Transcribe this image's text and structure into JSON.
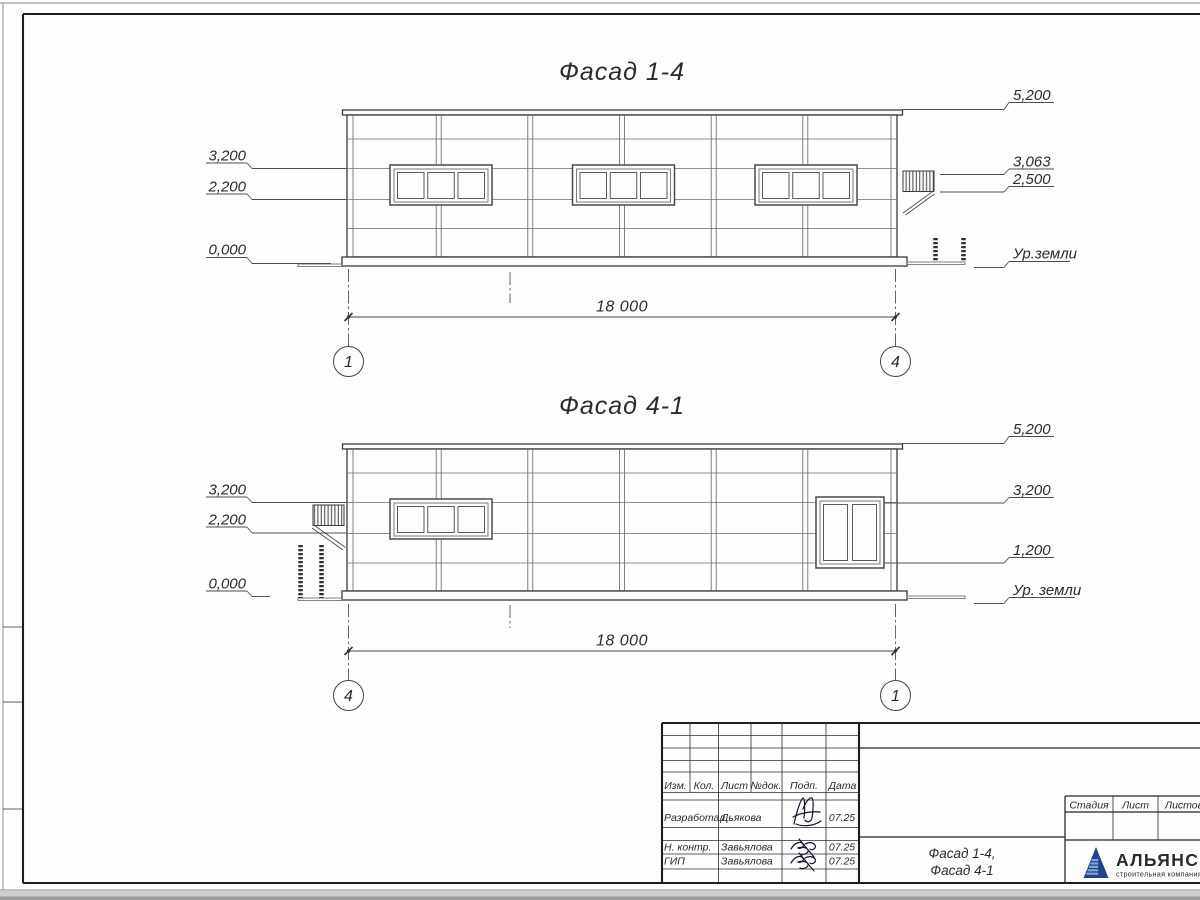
{
  "facades": [
    {
      "title": "Фасад 1-4",
      "dimension": "18 000",
      "axis_left": "1",
      "axis_right": "4",
      "levels_left": [
        "3,200",
        "2,200",
        "0,000"
      ],
      "levels_right": [
        "5,200",
        "3,063",
        "2,500"
      ],
      "ground_label": "Ур.земли"
    },
    {
      "title": "Фасад 4-1",
      "dimension": "18 000",
      "axis_left": "4",
      "axis_right": "1",
      "levels_left": [
        "3,200",
        "2,200",
        "0,000"
      ],
      "levels_right": [
        "5,200",
        "3,200",
        "1,200"
      ],
      "ground_label": "Ур. земли"
    }
  ],
  "title_block": {
    "header_columns": [
      "Изм.",
      "Кол.",
      "Лист",
      "№док.",
      "Подп.",
      "Дата"
    ],
    "rows": [
      {
        "role": "Разработал",
        "name": "Дьякова",
        "date": "07.25"
      },
      {
        "role": "Н. контр.",
        "name": "Завьялова",
        "date": "07.25"
      },
      {
        "role": "ГИП",
        "name": "Завьялова",
        "date": "07.25"
      }
    ],
    "doc_title": [
      "Фасад 1-4,",
      "Фасад 4-1"
    ],
    "stage_columns": [
      "Стадия",
      "Лист",
      "Листов"
    ],
    "logo_name": "АЛЬЯНС",
    "logo_subtitle": "строительная компания",
    "logo_blue": "#23418f",
    "logo_light_blue": "#7fa9da",
    "logo_red": "#e05a65"
  }
}
